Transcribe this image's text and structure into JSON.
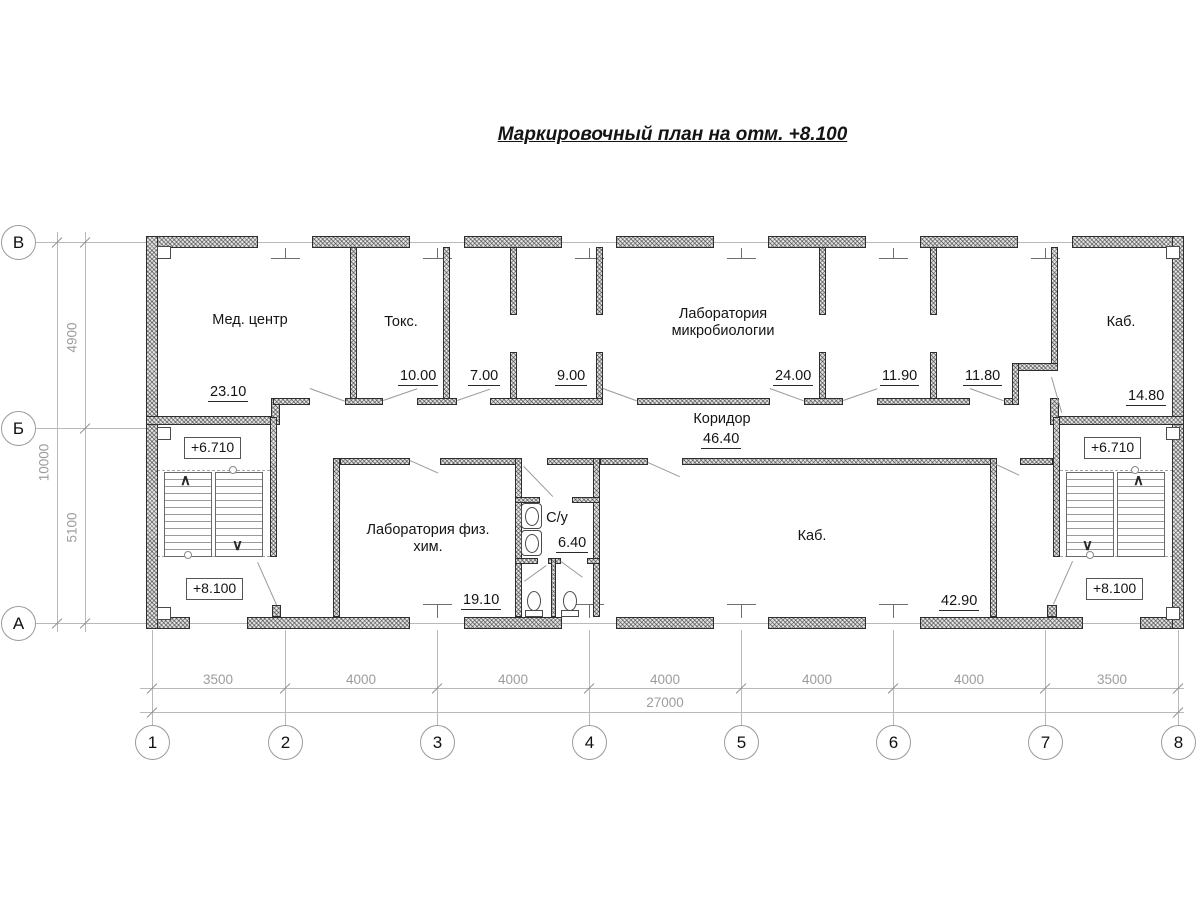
{
  "title": "Маркировочный план на отм. +8.100",
  "grid": {
    "row_labels": [
      "В",
      "Б",
      "А"
    ],
    "col_labels": [
      "1",
      "2",
      "3",
      "4",
      "5",
      "6",
      "7",
      "8"
    ]
  },
  "dimensions": {
    "left_segments": [
      "4900",
      "5100"
    ],
    "left_total": "10000",
    "bottom_segments": [
      "3500",
      "4000",
      "4000",
      "4000",
      "4000",
      "4000",
      "3500"
    ],
    "bottom_total": "27000"
  },
  "rooms": {
    "med_center": {
      "name": "Мед. центр",
      "area": "23.10"
    },
    "toks": {
      "name": "Токс.",
      "area": "10.00"
    },
    "room_7": {
      "area": "7.00"
    },
    "room_9": {
      "area": "9.00"
    },
    "lab_micro": {
      "name": "Лаборатория микробиологии",
      "area": "24.00"
    },
    "room_11_90": {
      "area": "11.90"
    },
    "room_11_80": {
      "area": "11.80"
    },
    "kab_top": {
      "name": "Каб.",
      "area": "14.80"
    },
    "koridor": {
      "name": "Коридор",
      "area": "46.40"
    },
    "lab_fiz": {
      "name": "Лаборатория физ. хим.",
      "area": "19.10"
    },
    "su": {
      "name": "С/у",
      "area": "6.40"
    },
    "kab_big": {
      "name": "Каб.",
      "area": "42.90"
    }
  },
  "elevations": {
    "landing": "+6.710",
    "floor": "+8.100"
  }
}
